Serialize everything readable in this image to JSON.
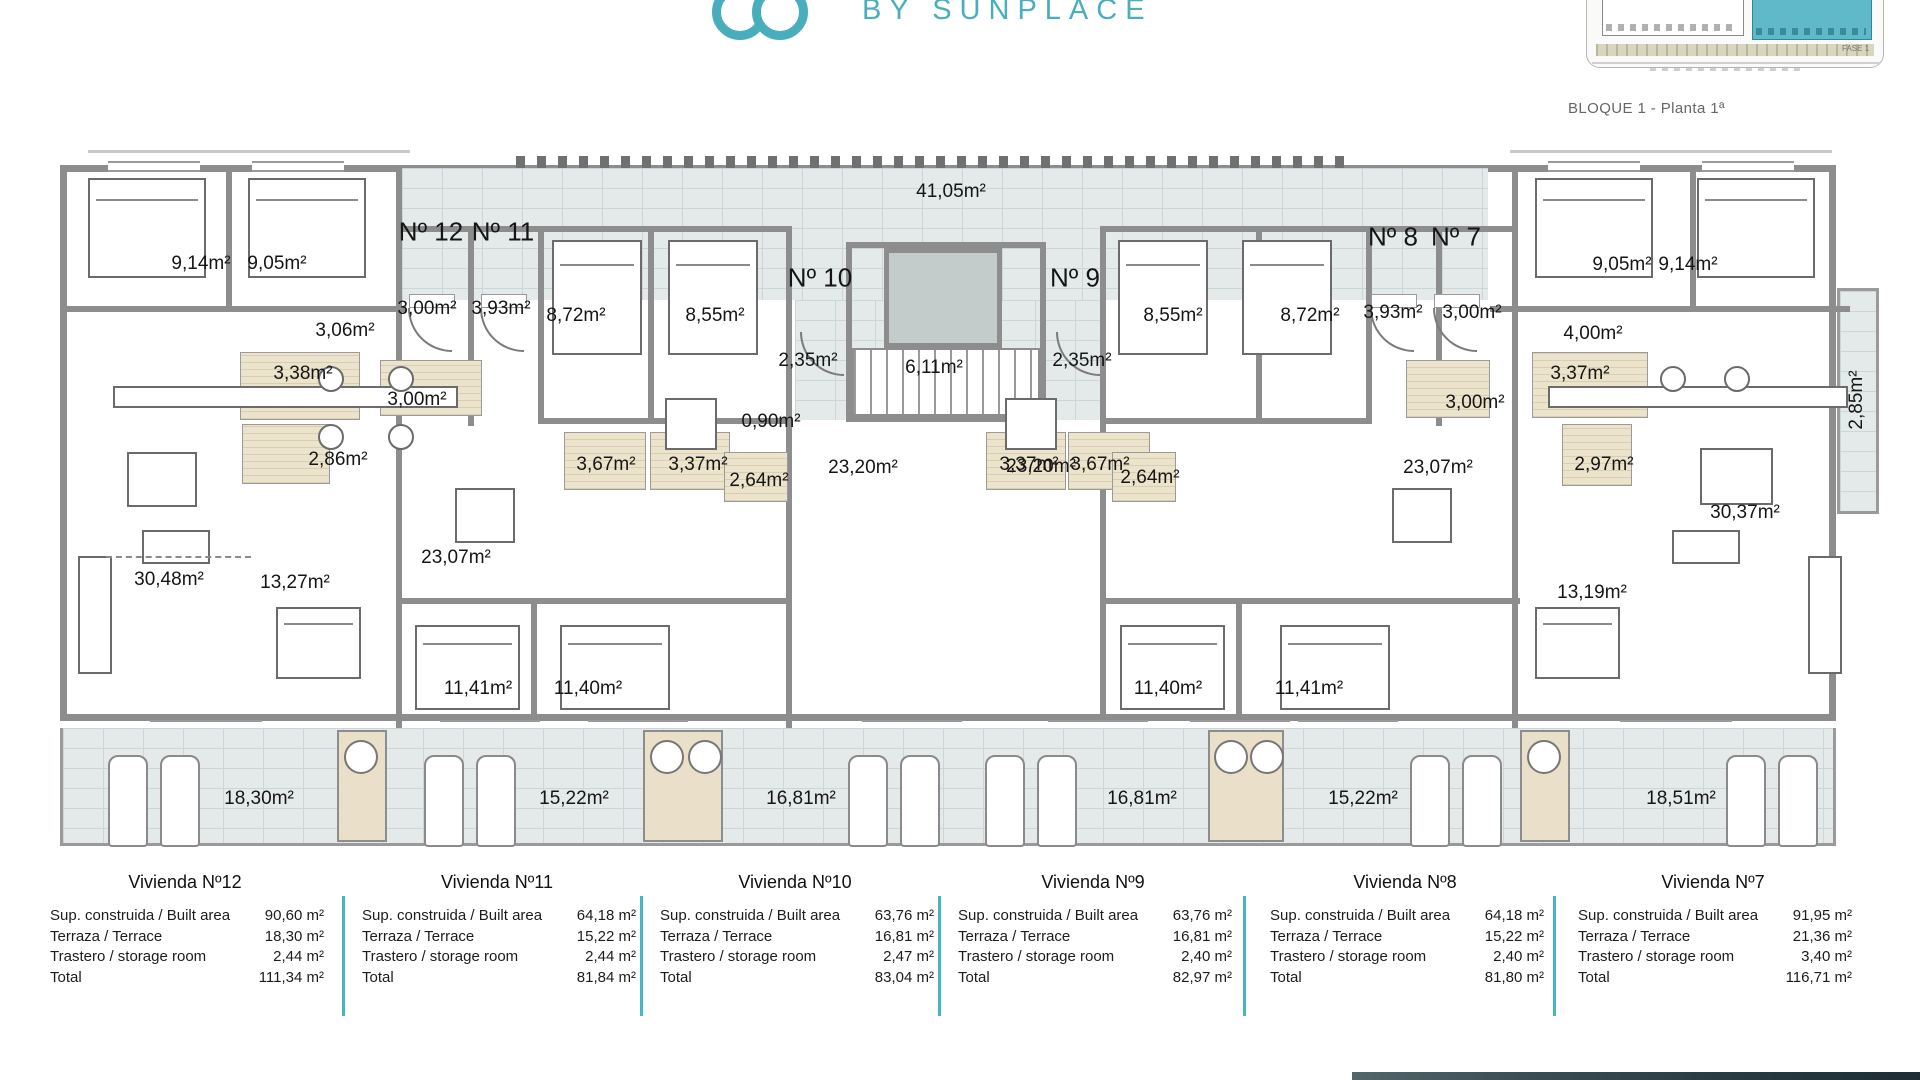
{
  "header": {
    "brand_text": "BY SUNPLACE",
    "caption": "BLOQUE 1 - Planta 1ª",
    "site_thumbnail": {
      "fase_label": "FASE 1"
    },
    "accent_color": "#47b6c4"
  },
  "floor_plan": {
    "apartment_numbers": [
      {
        "text": "Nº 12",
        "x": 431,
        "y": 232
      },
      {
        "text": "Nº 11",
        "x": 503,
        "y": 232
      },
      {
        "text": "Nº 10",
        "x": 820,
        "y": 278
      },
      {
        "text": "Nº 9",
        "x": 1075,
        "y": 278
      },
      {
        "text": "Nº 8",
        "x": 1393,
        "y": 237
      },
      {
        "text": "Nº 7",
        "x": 1456,
        "y": 237
      }
    ],
    "room_labels": [
      {
        "text": "9,14m²",
        "x": 201,
        "y": 264
      },
      {
        "text": "9,05m²",
        "x": 277,
        "y": 264
      },
      {
        "text": "3,06m²",
        "x": 345,
        "y": 331
      },
      {
        "text": "3,00m²",
        "x": 427,
        "y": 309
      },
      {
        "text": "3,93m²",
        "x": 501,
        "y": 309
      },
      {
        "text": "8,72m²",
        "x": 576,
        "y": 316
      },
      {
        "text": "8,55m²",
        "x": 715,
        "y": 316
      },
      {
        "text": "3,38m²",
        "x": 303,
        "y": 374
      },
      {
        "text": "3,00m²",
        "x": 417,
        "y": 400
      },
      {
        "text": "2,86m²",
        "x": 338,
        "y": 460
      },
      {
        "text": "3,67m²",
        "x": 606,
        "y": 465
      },
      {
        "text": "3,37m²",
        "x": 698,
        "y": 465
      },
      {
        "text": "2,64m²",
        "x": 759,
        "y": 481
      },
      {
        "text": "30,48m²",
        "x": 169,
        "y": 580
      },
      {
        "text": "13,27m²",
        "x": 295,
        "y": 583
      },
      {
        "text": "23,07m²",
        "x": 456,
        "y": 558
      },
      {
        "text": "11,41m²",
        "x": 478,
        "y": 689
      },
      {
        "text": "11,40m²",
        "x": 588,
        "y": 689
      },
      {
        "text": "41,05m²",
        "x": 951,
        "y": 192
      },
      {
        "text": "2,35m²",
        "x": 808,
        "y": 361
      },
      {
        "text": "6,11m²",
        "x": 934,
        "y": 368
      },
      {
        "text": "2,35m²",
        "x": 1082,
        "y": 361
      },
      {
        "text": "0,90m²",
        "x": 771,
        "y": 422
      },
      {
        "text": "23,20m²",
        "x": 863,
        "y": 468
      },
      {
        "text": "23,20m²",
        "x": 1041,
        "y": 467
      },
      {
        "text": "8,55m²",
        "x": 1173,
        "y": 316
      },
      {
        "text": "8,72m²",
        "x": 1310,
        "y": 316
      },
      {
        "text": "3,93m²",
        "x": 1393,
        "y": 313
      },
      {
        "text": "3,00m²",
        "x": 1472,
        "y": 313
      },
      {
        "text": "9,05m²",
        "x": 1622,
        "y": 265
      },
      {
        "text": "9,14m²",
        "x": 1688,
        "y": 265
      },
      {
        "text": "4,00m²",
        "x": 1593,
        "y": 334
      },
      {
        "text": "3,37m²",
        "x": 1029,
        "y": 465
      },
      {
        "text": "3,67m²",
        "x": 1100,
        "y": 465
      },
      {
        "text": "2,64m²",
        "x": 1150,
        "y": 478
      },
      {
        "text": "3,00m²",
        "x": 1475,
        "y": 403
      },
      {
        "text": "3,37m²",
        "x": 1580,
        "y": 374
      },
      {
        "text": "2,97m²",
        "x": 1604,
        "y": 465
      },
      {
        "text": "23,07m²",
        "x": 1438,
        "y": 468
      },
      {
        "text": "30,37m²",
        "x": 1745,
        "y": 513
      },
      {
        "text": "13,19m²",
        "x": 1592,
        "y": 593
      },
      {
        "text": "11,40m²",
        "x": 1168,
        "y": 689
      },
      {
        "text": "11,41m²",
        "x": 1309,
        "y": 689
      },
      {
        "text": "2,85m²",
        "x": 1857,
        "y": 400,
        "rot": -90
      }
    ],
    "terrace_labels": [
      {
        "text": "18,30m²",
        "x": 259,
        "y": 799
      },
      {
        "text": "15,22m²",
        "x": 574,
        "y": 799
      },
      {
        "text": "16,81m²",
        "x": 801,
        "y": 799
      },
      {
        "text": "16,81m²",
        "x": 1142,
        "y": 799
      },
      {
        "text": "15,22m²",
        "x": 1363,
        "y": 799
      },
      {
        "text": "18,51m²",
        "x": 1681,
        "y": 799
      }
    ]
  },
  "tables": {
    "row_labels": [
      "Sup. construida / Built area",
      "Terraza / Terrace",
      "Trastero / storage room",
      "Total"
    ],
    "units": [
      {
        "title": "Vivienda Nº12",
        "values": [
          "90,60 m²",
          "18,30 m²",
          "2,44 m²",
          "111,34 m²"
        ]
      },
      {
        "title": "Vivienda Nº11",
        "values": [
          "64,18 m²",
          "15,22 m²",
          "2,44 m²",
          "81,84 m²"
        ]
      },
      {
        "title": "Vivienda Nº10",
        "values": [
          "63,76 m²",
          "16,81 m²",
          "2,47 m²",
          "83,04 m²"
        ]
      },
      {
        "title": "Vivienda Nº9",
        "values": [
          "63,76 m²",
          "16,81 m²",
          "2,40 m²",
          "82,97 m²"
        ]
      },
      {
        "title": "Vivienda Nº8",
        "values": [
          "64,18 m²",
          "15,22 m²",
          "2,40 m²",
          "81,80 m²"
        ]
      },
      {
        "title": "Vivienda Nº7",
        "values": [
          "91,95 m²",
          "21,36 m²",
          "3,40 m²",
          "116,71 m²"
        ]
      }
    ]
  }
}
